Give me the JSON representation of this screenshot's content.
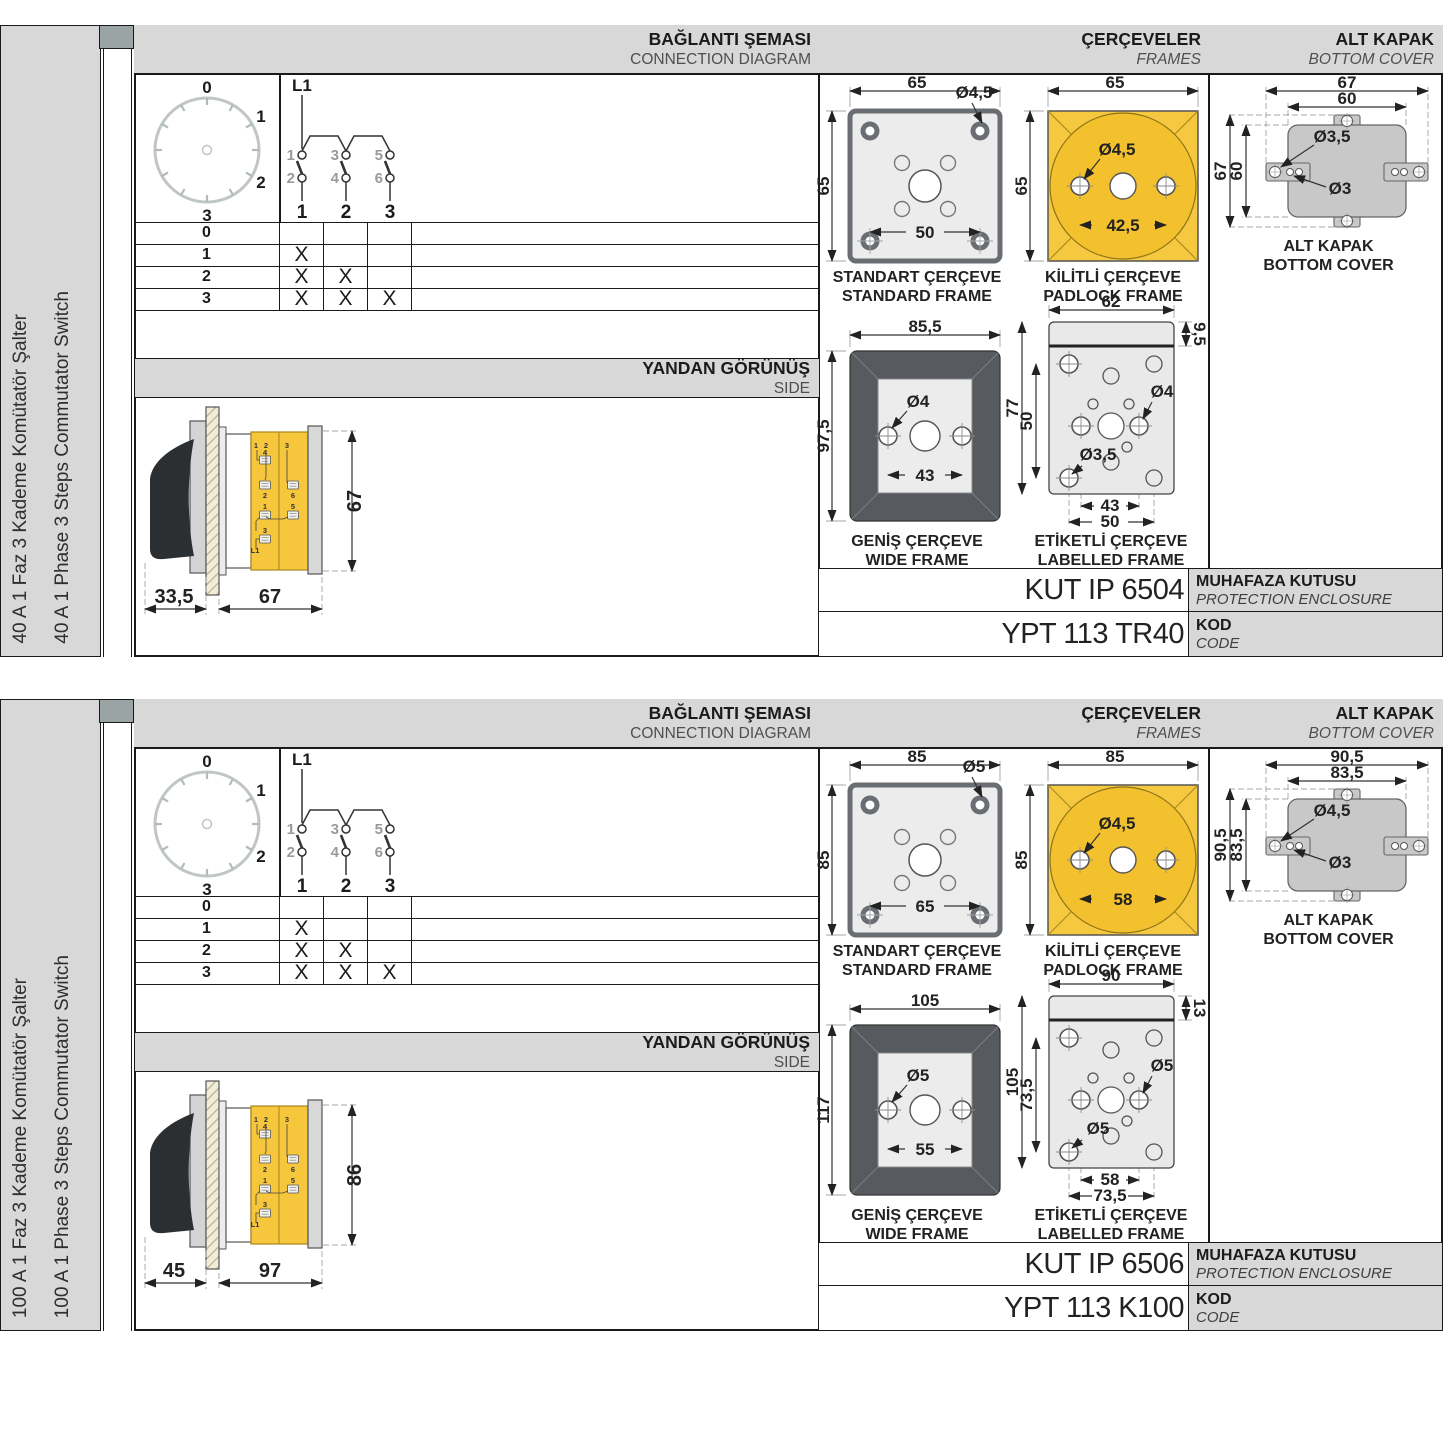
{
  "headers": {
    "connection_tr": "BAĞLANTI ŞEMASI",
    "connection_en": "CONNECTION DIAGRAM",
    "frames_tr": "ÇERÇEVELER",
    "frames_en": "FRAMES",
    "cover_tr": "ALT KAPAK",
    "cover_en": "BOTTOM COVER",
    "side_tr": "YANDAN GÖRÜNÜŞ",
    "side_en": "SIDE",
    "enclosure_tr": "MUHAFAZA KUTUSU",
    "enclosure_en": "PROTECTION ENCLOSURE",
    "code_tr": "KOD",
    "code_en": "CODE"
  },
  "frame_titles": {
    "standard_tr": "STANDART ÇERÇEVE",
    "standard_en": "STANDARD FRAME",
    "padlock_tr": "KİLİTLİ ÇERÇEVE",
    "padlock_en": "PADLOCK FRAME",
    "wide_tr": "GENİŞ ÇERÇEVE",
    "wide_en": "WIDE FRAME",
    "labelled_tr": "ETİKETLİ ÇERÇEVE",
    "labelled_en": "LABELLED FRAME",
    "cover_tr": "ALT KAPAK",
    "cover_en": "BOTTOM COVER"
  },
  "diagram": {
    "source": "L1",
    "dial_positions": [
      "0",
      "1",
      "2",
      "3"
    ],
    "contact_top": [
      "1",
      "3",
      "5"
    ],
    "contact_bottom": [
      "2",
      "4",
      "6"
    ],
    "pole_numbers": [
      "1",
      "2",
      "3"
    ],
    "table_rows": [
      {
        "pos": "0",
        "c1": "",
        "c2": "",
        "c3": ""
      },
      {
        "pos": "1",
        "c1": "X",
        "c2": "",
        "c3": ""
      },
      {
        "pos": "2",
        "c1": "X",
        "c2": "X",
        "c3": ""
      },
      {
        "pos": "3",
        "c1": "X",
        "c2": "X",
        "c3": "X"
      }
    ],
    "side_terminals": {
      "top1": "1",
      "top2": "2",
      "top3": "3",
      "mid4": "4",
      "mid2": "2",
      "mid6": "6",
      "mid1": "1",
      "mid5": "5",
      "mid3": "3",
      "l1": "L1"
    }
  },
  "colors": {
    "band": "#d8d8d8",
    "line": "#1a1a1a",
    "yellow": "#f6c63d",
    "frame_dark": "#575b5f",
    "fill_light": "#ececec",
    "cover_gray": "#c8c8c8",
    "tab_gray": "#9aa4a4"
  },
  "panels": [
    {
      "product_tr": "40 A 1 Faz 3 Kademe Komütatör Şalter",
      "product_en": "40 A 1 Phase 3 Steps Commutator Switch",
      "side_view": {
        "depth": "33,5",
        "body": "67",
        "height": "67"
      },
      "standard": {
        "w": "65",
        "h": "65",
        "hole": "Ø4,5",
        "pitch": "50"
      },
      "padlock": {
        "w": "65",
        "h": "65",
        "hole": "Ø4,5",
        "pitch": "42,5"
      },
      "wide": {
        "w": "85,5",
        "h": "97,5",
        "hole": "Ø4",
        "pitch": "43"
      },
      "labelled": {
        "w": "62",
        "strip": "9,5",
        "h": "77",
        "vpitch": "50",
        "hole_r": "Ø4",
        "hole_l": "Ø3,5",
        "pitch1": "43",
        "pitch2": "50"
      },
      "cover": {
        "w_out": "67",
        "w_in": "60",
        "h_out": "67",
        "h_in": "60",
        "hole_big": "Ø3,5",
        "hole_small": "Ø3"
      },
      "enclosure_code": "KUT IP 6504",
      "product_code": "YPT 113 TR40"
    },
    {
      "product_tr": "100 A 1 Faz 3 Kademe Komütatör Şalter",
      "product_en": "100 A 1 Phase 3 Steps Commutator Switch",
      "side_view": {
        "depth": "45",
        "body": "97",
        "height": "86"
      },
      "standard": {
        "w": "85",
        "h": "85",
        "hole": "Ø5",
        "pitch": "65"
      },
      "padlock": {
        "w": "85",
        "h": "85",
        "hole": "Ø4,5",
        "pitch": "58"
      },
      "wide": {
        "w": "105",
        "h": "117",
        "hole": "Ø5",
        "pitch": "55"
      },
      "labelled": {
        "w": "90",
        "strip": "13",
        "h": "105",
        "vpitch": "73,5",
        "hole_r": "Ø5",
        "hole_l": "Ø5",
        "pitch1": "58",
        "pitch2": "73,5"
      },
      "cover": {
        "w_out": "90,5",
        "w_in": "83,5",
        "h_out": "90,5",
        "h_in": "83,5",
        "hole_big": "Ø4,5",
        "hole_small": "Ø3"
      },
      "enclosure_code": "KUT IP 6506",
      "product_code": "YPT 113 K100"
    }
  ]
}
